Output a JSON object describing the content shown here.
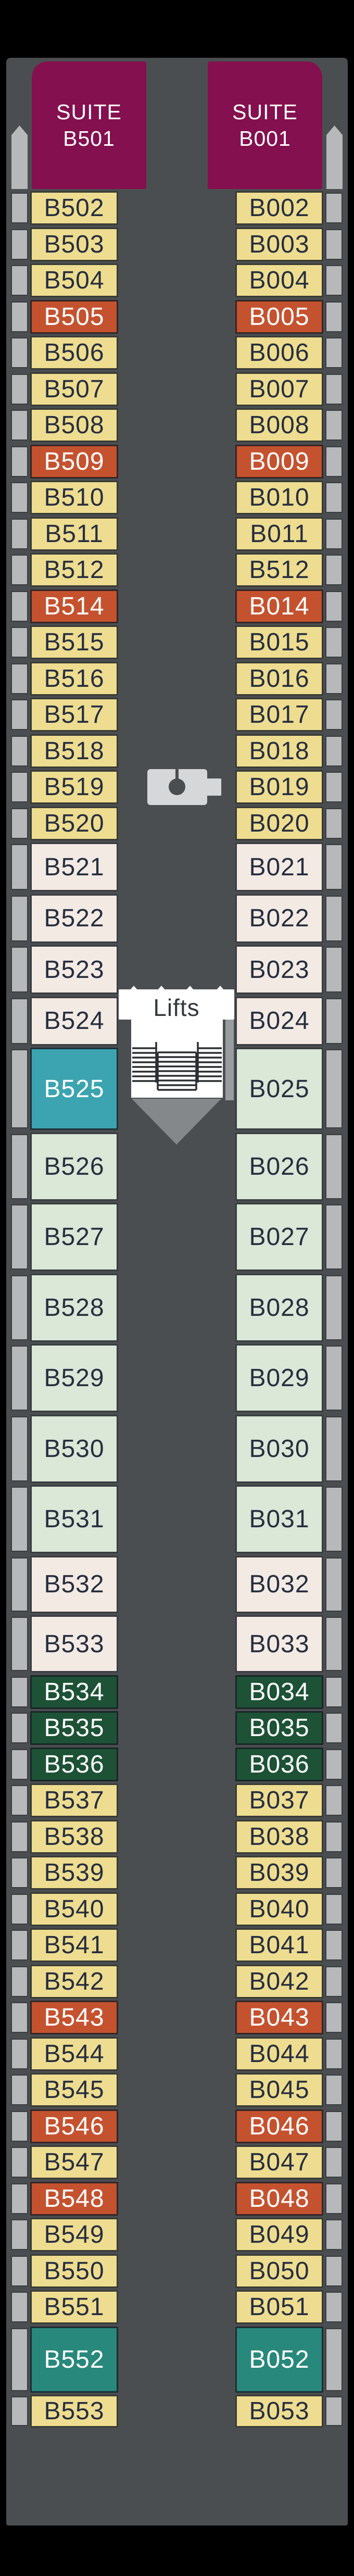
{
  "suites": {
    "left": {
      "line1": "SUITE",
      "line2": "B501"
    },
    "right": {
      "line1": "SUITE",
      "line2": "B001"
    }
  },
  "lifts": {
    "label": "Lifts"
  },
  "colors": {
    "background": "#000000",
    "deck": "#4b4e50",
    "purple": "#84104f",
    "yellow": "#eedd90",
    "orange": "#c5522f",
    "pink": "#f3eae4",
    "mint": "#dbe7d7",
    "green": "#1d5236",
    "teal1": "#3ba4b0",
    "teal2": "#28887b",
    "balcony": "#b6b8ba",
    "ink": "#262e3f"
  },
  "left_cabins": [
    {
      "label": "B502",
      "type": "yellow",
      "h": 65
    },
    {
      "label": "B503",
      "type": "yellow",
      "h": 65
    },
    {
      "label": "B504",
      "type": "yellow",
      "h": 65
    },
    {
      "label": "B505",
      "type": "orange",
      "h": 65
    },
    {
      "label": "B506",
      "type": "yellow",
      "h": 65
    },
    {
      "label": "B507",
      "type": "yellow",
      "h": 65
    },
    {
      "label": "B508",
      "type": "yellow",
      "h": 65
    },
    {
      "label": "B509",
      "type": "orange",
      "h": 65
    },
    {
      "label": "B510",
      "type": "yellow",
      "h": 65
    },
    {
      "label": "B511",
      "type": "yellow",
      "h": 65
    },
    {
      "label": "B512",
      "type": "yellow",
      "h": 65
    },
    {
      "label": "B514",
      "type": "orange",
      "h": 65
    },
    {
      "label": "B515",
      "type": "yellow",
      "h": 65
    },
    {
      "label": "B516",
      "type": "yellow",
      "h": 65
    },
    {
      "label": "B517",
      "type": "yellow",
      "h": 65
    },
    {
      "label": "B518",
      "type": "yellow",
      "h": 65
    },
    {
      "label": "B519",
      "type": "yellow",
      "h": 65
    },
    {
      "label": "B520",
      "type": "yellow",
      "h": 65
    },
    {
      "label": "B521",
      "type": "pink",
      "h": 94
    },
    {
      "label": "B522",
      "type": "pink",
      "h": 94
    },
    {
      "label": "B523",
      "type": "pink",
      "h": 94
    },
    {
      "label": "B524",
      "type": "pink",
      "h": 94
    },
    {
      "label": "B525",
      "type": "teal1",
      "h": 158
    },
    {
      "label": "B526",
      "type": "mint",
      "h": 131
    },
    {
      "label": "B527",
      "type": "mint",
      "h": 131
    },
    {
      "label": "B528",
      "type": "mint",
      "h": 131
    },
    {
      "label": "B529",
      "type": "mint",
      "h": 131
    },
    {
      "label": "B530",
      "type": "mint",
      "h": 131
    },
    {
      "label": "B531",
      "type": "mint",
      "h": 131
    },
    {
      "label": "B532",
      "type": "pink",
      "h": 110
    },
    {
      "label": "B533",
      "type": "pink",
      "h": 110
    },
    {
      "label": "B534",
      "type": "green",
      "h": 65
    },
    {
      "label": "B535",
      "type": "green",
      "h": 65
    },
    {
      "label": "B536",
      "type": "green",
      "h": 65
    },
    {
      "label": "B537",
      "type": "yellow",
      "h": 65
    },
    {
      "label": "B538",
      "type": "yellow",
      "h": 65
    },
    {
      "label": "B539",
      "type": "yellow",
      "h": 65
    },
    {
      "label": "B540",
      "type": "yellow",
      "h": 65
    },
    {
      "label": "B541",
      "type": "yellow",
      "h": 65
    },
    {
      "label": "B542",
      "type": "yellow",
      "h": 65
    },
    {
      "label": "B543",
      "type": "orange",
      "h": 65
    },
    {
      "label": "B544",
      "type": "yellow",
      "h": 65
    },
    {
      "label": "B545",
      "type": "yellow",
      "h": 65
    },
    {
      "label": "B546",
      "type": "orange",
      "h": 65
    },
    {
      "label": "B547",
      "type": "yellow",
      "h": 65
    },
    {
      "label": "B548",
      "type": "orange",
      "h": 65
    },
    {
      "label": "B549",
      "type": "yellow",
      "h": 65
    },
    {
      "label": "B550",
      "type": "yellow",
      "h": 65
    },
    {
      "label": "B551",
      "type": "yellow",
      "h": 65
    },
    {
      "label": "B552",
      "type": "teal2",
      "h": 127
    },
    {
      "label": "B553",
      "type": "yellow",
      "h": 63
    }
  ],
  "right_cabins": [
    {
      "label": "B002",
      "type": "yellow",
      "h": 65
    },
    {
      "label": "B003",
      "type": "yellow",
      "h": 65
    },
    {
      "label": "B004",
      "type": "yellow",
      "h": 65
    },
    {
      "label": "B005",
      "type": "orange",
      "h": 65
    },
    {
      "label": "B006",
      "type": "yellow",
      "h": 65
    },
    {
      "label": "B007",
      "type": "yellow",
      "h": 65
    },
    {
      "label": "B008",
      "type": "yellow",
      "h": 65
    },
    {
      "label": "B009",
      "type": "orange",
      "h": 65
    },
    {
      "label": "B010",
      "type": "yellow",
      "h": 65
    },
    {
      "label": "B011",
      "type": "yellow",
      "h": 65
    },
    {
      "label": "B512",
      "type": "yellow",
      "h": 65
    },
    {
      "label": "B014",
      "type": "orange",
      "h": 65
    },
    {
      "label": "B015",
      "type": "yellow",
      "h": 65
    },
    {
      "label": "B016",
      "type": "yellow",
      "h": 65
    },
    {
      "label": "B017",
      "type": "yellow",
      "h": 65
    },
    {
      "label": "B018",
      "type": "yellow",
      "h": 65
    },
    {
      "label": "B019",
      "type": "yellow",
      "h": 65
    },
    {
      "label": "B020",
      "type": "yellow",
      "h": 65
    },
    {
      "label": "B021",
      "type": "pink",
      "h": 94
    },
    {
      "label": "B022",
      "type": "pink",
      "h": 94
    },
    {
      "label": "B023",
      "type": "pink",
      "h": 94
    },
    {
      "label": "B024",
      "type": "pink",
      "h": 94
    },
    {
      "label": "B025",
      "type": "mint",
      "h": 158
    },
    {
      "label": "B026",
      "type": "mint",
      "h": 131
    },
    {
      "label": "B027",
      "type": "mint",
      "h": 131
    },
    {
      "label": "B028",
      "type": "mint",
      "h": 131
    },
    {
      "label": "B029",
      "type": "mint",
      "h": 131
    },
    {
      "label": "B030",
      "type": "mint",
      "h": 131
    },
    {
      "label": "B031",
      "type": "mint",
      "h": 131
    },
    {
      "label": "B032",
      "type": "pink",
      "h": 110
    },
    {
      "label": "B033",
      "type": "pink",
      "h": 110
    },
    {
      "label": "B034",
      "type": "green",
      "h": 65
    },
    {
      "label": "B035",
      "type": "green",
      "h": 65
    },
    {
      "label": "B036",
      "type": "green",
      "h": 65
    },
    {
      "label": "B037",
      "type": "yellow",
      "h": 65
    },
    {
      "label": "B038",
      "type": "yellow",
      "h": 65
    },
    {
      "label": "B039",
      "type": "yellow",
      "h": 65
    },
    {
      "label": "B040",
      "type": "yellow",
      "h": 65
    },
    {
      "label": "B041",
      "type": "yellow",
      "h": 65
    },
    {
      "label": "B042",
      "type": "yellow",
      "h": 65
    },
    {
      "label": "B043",
      "type": "orange",
      "h": 65
    },
    {
      "label": "B044",
      "type": "yellow",
      "h": 65
    },
    {
      "label": "B045",
      "type": "yellow",
      "h": 65
    },
    {
      "label": "B046",
      "type": "orange",
      "h": 65
    },
    {
      "label": "B047",
      "type": "yellow",
      "h": 65
    },
    {
      "label": "B048",
      "type": "orange",
      "h": 65
    },
    {
      "label": "B049",
      "type": "yellow",
      "h": 65
    },
    {
      "label": "B050",
      "type": "yellow",
      "h": 65
    },
    {
      "label": "B051",
      "type": "yellow",
      "h": 65
    },
    {
      "label": "B052",
      "type": "teal2",
      "h": 127
    },
    {
      "label": "B053",
      "type": "yellow",
      "h": 63
    }
  ]
}
